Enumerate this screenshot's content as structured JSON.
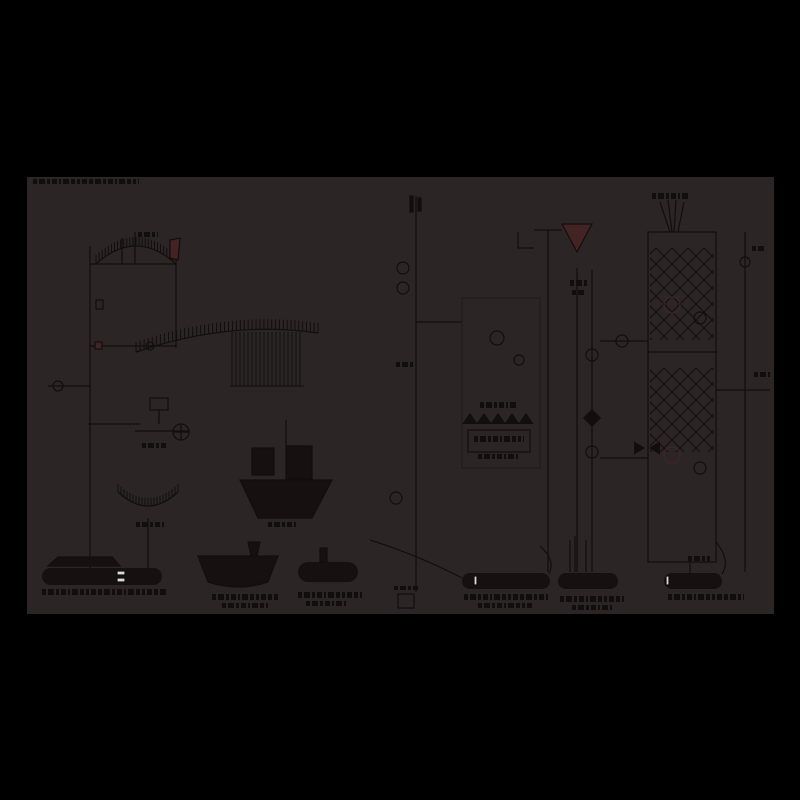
{
  "figure": {
    "description": "very dark industrial process flow diagram on black background",
    "canvas": {
      "x": 27,
      "y": 177,
      "width": 747,
      "height": 437
    }
  },
  "colors": {
    "page_bg": "#000000",
    "canvas_bg": "#2b2525",
    "ink": "#130e0e",
    "ink_soft": "#241c1c",
    "accent_red": "#432323",
    "vessel_fill": "#161010",
    "highlight": "#d9d9d9"
  },
  "elements": [
    {
      "type": "smudge",
      "name": "title-text",
      "x": 33,
      "y": 179,
      "w": 106,
      "h": 5
    },
    {
      "type": "line",
      "name": "left-main-pipe",
      "x1": 90,
      "y1": 246,
      "x2": 90,
      "y2": 568
    },
    {
      "type": "curvehatch",
      "name": "elevator-arch-hatch",
      "x1": 96,
      "y1": 264,
      "cx": 136,
      "cy": 228,
      "x2": 176,
      "y2": 264,
      "n": 26,
      "len": 9
    },
    {
      "type": "polygon",
      "name": "arch-red-chute",
      "pts": [
        [
          170,
          240
        ],
        [
          180,
          238
        ],
        [
          178,
          260
        ],
        [
          170,
          258
        ]
      ],
      "fill": "accent_red"
    },
    {
      "type": "smudge",
      "name": "arch-label",
      "x": 138,
      "y": 232,
      "w": 20,
      "h": 5
    },
    {
      "type": "line",
      "name": "arch-baseline",
      "x1": 90,
      "y1": 264,
      "x2": 176,
      "y2": 264
    },
    {
      "type": "line",
      "name": "arch-right-riser",
      "x1": 176,
      "y1": 264,
      "x2": 176,
      "y2": 348
    },
    {
      "type": "line",
      "name": "arch-riser-a",
      "x1": 122,
      "y1": 238,
      "x2": 122,
      "y2": 264
    },
    {
      "type": "line",
      "name": "arch-riser-b",
      "x1": 135,
      "y1": 232,
      "x2": 135,
      "y2": 264
    },
    {
      "type": "curvehatch",
      "name": "main-conveyor-hatch",
      "x1": 136,
      "y1": 352,
      "cx": 230,
      "cy": 320,
      "x2": 318,
      "y2": 333,
      "n": 46,
      "len": 10
    },
    {
      "type": "vlines",
      "name": "conveyor-curtain",
      "x1": 232,
      "x2": 302,
      "step": 4,
      "ytop": 332,
      "ybot": 385
    },
    {
      "type": "line",
      "name": "curtain-base",
      "x1": 230,
      "y1": 386,
      "x2": 304,
      "y2": 386
    },
    {
      "type": "line",
      "name": "valve-row-line",
      "x1": 90,
      "y1": 346,
      "x2": 176,
      "y2": 346
    },
    {
      "type": "valve",
      "name": "feed-valve-1",
      "cx": 104,
      "cy": 346,
      "s": 7
    },
    {
      "type": "valve",
      "name": "feed-valve-2",
      "cx": 120,
      "cy": 346,
      "s": 7
    },
    {
      "type": "valve",
      "name": "feed-valve-3",
      "cx": 134,
      "cy": 346,
      "s": 6
    },
    {
      "type": "circle",
      "name": "inline-instrument",
      "cx": 150,
      "cy": 346,
      "r": 4
    },
    {
      "type": "rect",
      "name": "red-port",
      "x": 95,
      "y": 342,
      "w": 7,
      "h": 7,
      "fill": "accent_red"
    },
    {
      "type": "line",
      "name": "left-branch-line",
      "x1": 48,
      "y1": 386,
      "x2": 90,
      "y2": 386
    },
    {
      "type": "valve",
      "name": "left-valve-1",
      "cx": 72,
      "cy": 386,
      "s": 6
    },
    {
      "type": "valve",
      "name": "left-valve-2",
      "cx": 85,
      "cy": 386,
      "s": 6
    },
    {
      "type": "circle",
      "name": "left-pump",
      "cx": 58,
      "cy": 386,
      "r": 5
    },
    {
      "type": "rect",
      "name": "small-box-left",
      "x": 96,
      "y": 300,
      "w": 7,
      "h": 9
    },
    {
      "type": "line",
      "name": "branch-line-2",
      "x1": 88,
      "y1": 424,
      "x2": 140,
      "y2": 424
    },
    {
      "type": "valve",
      "name": "branch-valve",
      "cx": 108,
      "cy": 424,
      "s": 7
    },
    {
      "type": "rect",
      "name": "mid-box",
      "x": 150,
      "y": 398,
      "w": 18,
      "h": 12
    },
    {
      "type": "line",
      "name": "mid-drop",
      "x1": 159,
      "y1": 410,
      "x2": 159,
      "y2": 424
    },
    {
      "type": "valve",
      "name": "mid-valve-1",
      "cx": 144,
      "cy": 431,
      "s": 6
    },
    {
      "type": "valve",
      "name": "mid-valve-2",
      "cx": 160,
      "cy": 431,
      "s": 7
    },
    {
      "type": "circlecross",
      "name": "mid-instrument",
      "cx": 181,
      "cy": 432,
      "r": 8
    },
    {
      "type": "line",
      "name": "mid-line",
      "x1": 135,
      "y1": 431,
      "x2": 190,
      "y2": 431
    },
    {
      "type": "smudge",
      "name": "mid-label",
      "x": 142,
      "y": 443,
      "w": 26,
      "h": 5
    },
    {
      "type": "curvehatch",
      "name": "boot-arch-hatch",
      "x1": 118,
      "y1": 492,
      "cx": 148,
      "cy": 520,
      "x2": 178,
      "y2": 492,
      "n": 20,
      "len": 8
    },
    {
      "type": "line",
      "name": "boot-drop",
      "x1": 148,
      "y1": 518,
      "x2": 148,
      "y2": 568
    },
    {
      "type": "smudge",
      "name": "boot-label",
      "x": 136,
      "y": 522,
      "w": 28,
      "h": 5
    },
    {
      "type": "line",
      "name": "center-pipe",
      "x1": 416,
      "y1": 196,
      "x2": 416,
      "y2": 560
    },
    {
      "type": "rect",
      "name": "center-top-tick-1",
      "x": 410,
      "y": 196,
      "w": 3,
      "h": 16,
      "fill": "ink"
    },
    {
      "type": "rect",
      "name": "center-top-tick-2",
      "x": 418,
      "y": 198,
      "w": 3,
      "h": 13,
      "fill": "ink"
    },
    {
      "type": "circle",
      "name": "center-instrument-1",
      "cx": 403,
      "cy": 268,
      "r": 6
    },
    {
      "type": "circle",
      "name": "center-instrument-2",
      "cx": 403,
      "cy": 288,
      "r": 6
    },
    {
      "type": "smudge",
      "name": "center-pipe-label",
      "x": 396,
      "y": 362,
      "w": 18,
      "h": 5
    },
    {
      "type": "circle",
      "name": "center-instrument-3",
      "cx": 396,
      "cy": 498,
      "r": 6
    },
    {
      "type": "valve",
      "name": "center-valve",
      "cx": 410,
      "cy": 500,
      "s": 6
    },
    {
      "type": "line",
      "name": "center-bottom-drop",
      "x1": 416,
      "y1": 560,
      "x2": 416,
      "y2": 592
    },
    {
      "type": "line",
      "name": "screen-tie",
      "x1": 416,
      "y1": 322,
      "x2": 462,
      "y2": 322
    },
    {
      "type": "line",
      "name": "hopper-feed-drop",
      "x1": 286,
      "y1": 420,
      "x2": 286,
      "y2": 446
    },
    {
      "type": "rect",
      "name": "hopper-box-1",
      "x": 252,
      "y": 448,
      "w": 22,
      "h": 27,
      "fill": "vessel_fill"
    },
    {
      "type": "rect",
      "name": "hopper-box-2",
      "x": 286,
      "y": 446,
      "w": 26,
      "h": 33,
      "fill": "vessel_fill"
    },
    {
      "type": "valve",
      "name": "hopper-x-valve",
      "cx": 318,
      "cy": 462,
      "s": 12
    },
    {
      "type": "polygon",
      "name": "hopper-body",
      "pts": [
        [
          240,
          480
        ],
        [
          332,
          480
        ],
        [
          312,
          518
        ],
        [
          258,
          518
        ]
      ],
      "fill": "vessel_fill"
    },
    {
      "type": "smudge",
      "name": "hopper-label",
      "x": 268,
      "y": 522,
      "w": 30,
      "h": 5
    },
    {
      "type": "rect",
      "name": "screen-body",
      "x": 462,
      "y": 298,
      "w": 78,
      "h": 170,
      "c": "ink_soft"
    },
    {
      "type": "valve",
      "name": "screen-valve-1",
      "cx": 478,
      "cy": 320,
      "s": 7
    },
    {
      "type": "valve",
      "name": "screen-valve-2",
      "cx": 512,
      "cy": 322,
      "s": 7
    },
    {
      "type": "circle",
      "name": "screen-instrument-1",
      "cx": 497,
      "cy": 338,
      "r": 7
    },
    {
      "type": "valve",
      "name": "screen-main-valve",
      "cx": 497,
      "cy": 358,
      "s": 9
    },
    {
      "type": "circle",
      "name": "screen-instrument-2",
      "cx": 519,
      "cy": 360,
      "r": 5
    },
    {
      "type": "smudge",
      "name": "screen-label-1",
      "x": 480,
      "y": 402,
      "w": 36,
      "h": 6
    },
    {
      "type": "trirow",
      "name": "screen-triangle-row",
      "x": 470,
      "y": 424,
      "n": 5,
      "dx": 14,
      "s": 11
    },
    {
      "type": "rect",
      "name": "screen-box",
      "x": 468,
      "y": 430,
      "w": 62,
      "h": 22
    },
    {
      "type": "smudge",
      "name": "screen-label-2",
      "x": 474,
      "y": 436,
      "w": 50,
      "h": 6
    },
    {
      "type": "smudge",
      "name": "screen-label-3",
      "x": 478,
      "y": 454,
      "w": 40,
      "h": 5
    },
    {
      "type": "path",
      "name": "feed-bracket",
      "d": "M 518 232 L 518 248 L 534 248"
    },
    {
      "type": "line",
      "name": "funnel-feed-line",
      "x1": 534,
      "y1": 230,
      "x2": 562,
      "y2": 230
    },
    {
      "type": "line",
      "name": "mid-column-pipe",
      "x1": 548,
      "y1": 230,
      "x2": 548,
      "y2": 572
    },
    {
      "type": "polygon",
      "name": "feed-funnel",
      "pts": [
        [
          562,
          224
        ],
        [
          592,
          224
        ],
        [
          577,
          252
        ]
      ],
      "fill": "accent_red"
    },
    {
      "type": "valve",
      "name": "funnel-valve",
      "cx": 577,
      "cy": 260,
      "s": 9
    },
    {
      "type": "smudge",
      "name": "funnel-label-1",
      "x": 570,
      "y": 280,
      "w": 18,
      "h": 6
    },
    {
      "type": "smudge",
      "name": "funnel-label-2",
      "x": 572,
      "y": 290,
      "w": 14,
      "h": 5
    },
    {
      "type": "line",
      "name": "column2-pipe",
      "x1": 577,
      "y1": 268,
      "x2": 577,
      "y2": 572
    },
    {
      "type": "line",
      "name": "column2-pipe-b",
      "x1": 592,
      "y1": 270,
      "x2": 592,
      "y2": 572
    },
    {
      "type": "valve",
      "name": "column2-valve-1",
      "cx": 592,
      "cy": 302,
      "s": 7
    },
    {
      "type": "circle",
      "name": "column2-instrument-1",
      "cx": 592,
      "cy": 355,
      "r": 6
    },
    {
      "type": "diamond",
      "name": "column2-diamond",
      "cx": 592,
      "cy": 418,
      "s": 9
    },
    {
      "type": "circle",
      "name": "column2-instrument-2",
      "cx": 592,
      "cy": 452,
      "r": 6
    },
    {
      "type": "valve",
      "name": "column2-valve-2",
      "cx": 592,
      "cy": 520,
      "s": 7
    },
    {
      "type": "line",
      "name": "cross-tie-1",
      "x1": 600,
      "y1": 341,
      "x2": 648,
      "y2": 341
    },
    {
      "type": "circle",
      "name": "tie-instrument",
      "cx": 622,
      "cy": 341,
      "r": 6
    },
    {
      "type": "line",
      "name": "cross-tie-2",
      "x1": 600,
      "y1": 458,
      "x2": 648,
      "y2": 458
    },
    {
      "type": "rect",
      "name": "packed-column-shell",
      "x": 648,
      "y": 232,
      "w": 68,
      "h": 330
    },
    {
      "type": "lattice",
      "name": "packing-upper",
      "x": 650,
      "y": 248,
      "w": 64,
      "h": 92
    },
    {
      "type": "lattice",
      "name": "packing-lower",
      "x": 650,
      "y": 368,
      "w": 64,
      "h": 84
    },
    {
      "type": "circle",
      "name": "nozzle-1",
      "cx": 672,
      "cy": 305,
      "r": 8,
      "c": "accent_red"
    },
    {
      "type": "circle",
      "name": "nozzle-2",
      "cx": 700,
      "cy": 318,
      "r": 6
    },
    {
      "type": "circle",
      "name": "nozzle-3",
      "cx": 672,
      "cy": 455,
      "r": 8,
      "c": "accent_red"
    },
    {
      "type": "circle",
      "name": "nozzle-4",
      "cx": 700,
      "cy": 468,
      "r": 6
    },
    {
      "type": "line",
      "name": "column-mid-line",
      "x1": 648,
      "y1": 352,
      "x2": 716,
      "y2": 352
    },
    {
      "type": "tri",
      "name": "arrow-right-glyph",
      "cx": 634,
      "cy": 448,
      "s": 11,
      "dir": "right"
    },
    {
      "type": "tri",
      "name": "arrow-left-glyph",
      "cx": 660,
      "cy": 448,
      "s": 11,
      "dir": "left"
    },
    {
      "type": "valve",
      "name": "column-bottom-valve",
      "cx": 678,
      "cy": 548,
      "s": 8
    },
    {
      "type": "smudge",
      "name": "column-bottom-label",
      "x": 688,
      "y": 556,
      "w": 22,
      "h": 5
    },
    {
      "type": "line",
      "name": "fan-line-1",
      "x1": 660,
      "y1": 202,
      "x2": 670,
      "y2": 232
    },
    {
      "type": "line",
      "name": "fan-line-2",
      "x1": 668,
      "y1": 200,
      "x2": 672,
      "y2": 232
    },
    {
      "type": "line",
      "name": "fan-line-3",
      "x1": 676,
      "y1": 200,
      "x2": 674,
      "y2": 232
    },
    {
      "type": "line",
      "name": "fan-line-4",
      "x1": 684,
      "y1": 202,
      "x2": 678,
      "y2": 232
    },
    {
      "type": "smudge",
      "name": "column-top-label",
      "x": 652,
      "y": 193,
      "w": 38,
      "h": 6
    },
    {
      "type": "line",
      "name": "right-pipe",
      "x1": 745,
      "y1": 232,
      "x2": 745,
      "y2": 572
    },
    {
      "type": "circle",
      "name": "right-instrument",
      "cx": 745,
      "cy": 262,
      "r": 5
    },
    {
      "type": "smudge",
      "name": "right-label-1",
      "x": 752,
      "y": 246,
      "w": 14,
      "h": 5
    },
    {
      "type": "valve",
      "name": "right-valve",
      "cx": 745,
      "cy": 382,
      "s": 6
    },
    {
      "type": "line",
      "name": "right-tie",
      "x1": 716,
      "y1": 390,
      "x2": 770,
      "y2": 390
    },
    {
      "type": "smudge",
      "name": "right-label-2",
      "x": 754,
      "y": 372,
      "w": 16,
      "h": 5
    },
    {
      "type": "polygon",
      "name": "tank1-hood",
      "pts": [
        [
          48,
          566
        ],
        [
          58,
          557
        ],
        [
          112,
          557
        ],
        [
          120,
          566
        ]
      ],
      "fill": "vessel_fill"
    },
    {
      "type": "tank",
      "name": "tank-1",
      "x": 42,
      "y": 568,
      "w": 120,
      "h": 17
    },
    {
      "type": "rect",
      "name": "sight-glass-1a",
      "x": 117,
      "y": 571,
      "w": 8,
      "h": 4,
      "fill": "highlight"
    },
    {
      "type": "rect",
      "name": "sight-glass-1b",
      "x": 117,
      "y": 578,
      "w": 8,
      "h": 4,
      "fill": "highlight"
    },
    {
      "type": "smudge",
      "name": "tank1-caption",
      "x": 42,
      "y": 589,
      "w": 126,
      "h": 6
    },
    {
      "type": "path",
      "name": "boat-vessel",
      "d": "M 198 556 L 278 556 L 268 582 Q 239 592 208 582 Z",
      "fill": "vessel_fill"
    },
    {
      "type": "polygon",
      "name": "boat-funnel",
      "pts": [
        [
          248,
          542
        ],
        [
          260,
          542
        ],
        [
          257,
          556
        ],
        [
          251,
          556
        ]
      ],
      "fill": "vessel_fill"
    },
    {
      "type": "smudge",
      "name": "boat-caption-1",
      "x": 212,
      "y": 594,
      "w": 66,
      "h": 6
    },
    {
      "type": "smudge",
      "name": "boat-caption-2",
      "x": 222,
      "y": 603,
      "w": 46,
      "h": 5
    },
    {
      "type": "tank",
      "name": "vessel-3",
      "x": 298,
      "y": 562,
      "w": 60,
      "h": 20
    },
    {
      "type": "rect",
      "name": "vessel3-stack",
      "x": 320,
      "y": 548,
      "w": 7,
      "h": 14,
      "fill": "vessel_fill"
    },
    {
      "type": "smudge",
      "name": "vessel3-caption-1",
      "x": 298,
      "y": 592,
      "w": 64,
      "h": 6
    },
    {
      "type": "smudge",
      "name": "vessel3-caption-2",
      "x": 306,
      "y": 601,
      "w": 40,
      "h": 5
    },
    {
      "type": "tank",
      "name": "tank-4",
      "x": 462,
      "y": 573,
      "w": 88,
      "h": 16
    },
    {
      "type": "rect",
      "name": "sight-glass-4",
      "x": 474,
      "y": 576,
      "w": 3,
      "h": 9,
      "fill": "highlight"
    },
    {
      "type": "smudge",
      "name": "tank4-caption-1",
      "x": 464,
      "y": 594,
      "w": 84,
      "h": 6
    },
    {
      "type": "smudge",
      "name": "tank4-caption-2",
      "x": 478,
      "y": 603,
      "w": 56,
      "h": 5
    },
    {
      "type": "tank",
      "name": "tank-5",
      "x": 558,
      "y": 573,
      "w": 60,
      "h": 16
    },
    {
      "type": "smudge",
      "name": "tank5-caption-1",
      "x": 560,
      "y": 596,
      "w": 64,
      "h": 6
    },
    {
      "type": "smudge",
      "name": "tank5-caption-2",
      "x": 572,
      "y": 605,
      "w": 40,
      "h": 5
    },
    {
      "type": "tank",
      "name": "tank-6",
      "x": 664,
      "y": 573,
      "w": 58,
      "h": 16
    },
    {
      "type": "rect",
      "name": "sight-glass-6",
      "x": 666,
      "y": 576,
      "w": 3,
      "h": 9,
      "fill": "highlight"
    },
    {
      "type": "smudge",
      "name": "tank6-caption",
      "x": 668,
      "y": 594,
      "w": 76,
      "h": 6
    },
    {
      "type": "rect",
      "name": "small-vessel",
      "x": 398,
      "y": 594,
      "w": 16,
      "h": 14
    },
    {
      "type": "smudge",
      "name": "small-vessel-label",
      "x": 394,
      "y": 586,
      "w": 24,
      "h": 4
    },
    {
      "type": "path",
      "name": "drop-curve-1",
      "d": "M 370 540 Q 420 556 462 578"
    },
    {
      "type": "path",
      "name": "drop-curve-2",
      "d": "M 540 546 Q 556 560 549 574"
    },
    {
      "type": "path",
      "name": "drop-curve-3",
      "d": "M 716 542 Q 731 560 722 574"
    },
    {
      "type": "line",
      "name": "drop-a",
      "x1": 570,
      "y1": 540,
      "x2": 570,
      "y2": 572
    },
    {
      "type": "line",
      "name": "drop-b",
      "x1": 575,
      "y1": 536,
      "x2": 575,
      "y2": 572
    },
    {
      "type": "line",
      "name": "drop-c",
      "x1": 586,
      "y1": 540,
      "x2": 586,
      "y2": 572
    },
    {
      "type": "line",
      "name": "drop-d",
      "x1": 690,
      "y1": 560,
      "x2": 690,
      "y2": 573
    }
  ]
}
